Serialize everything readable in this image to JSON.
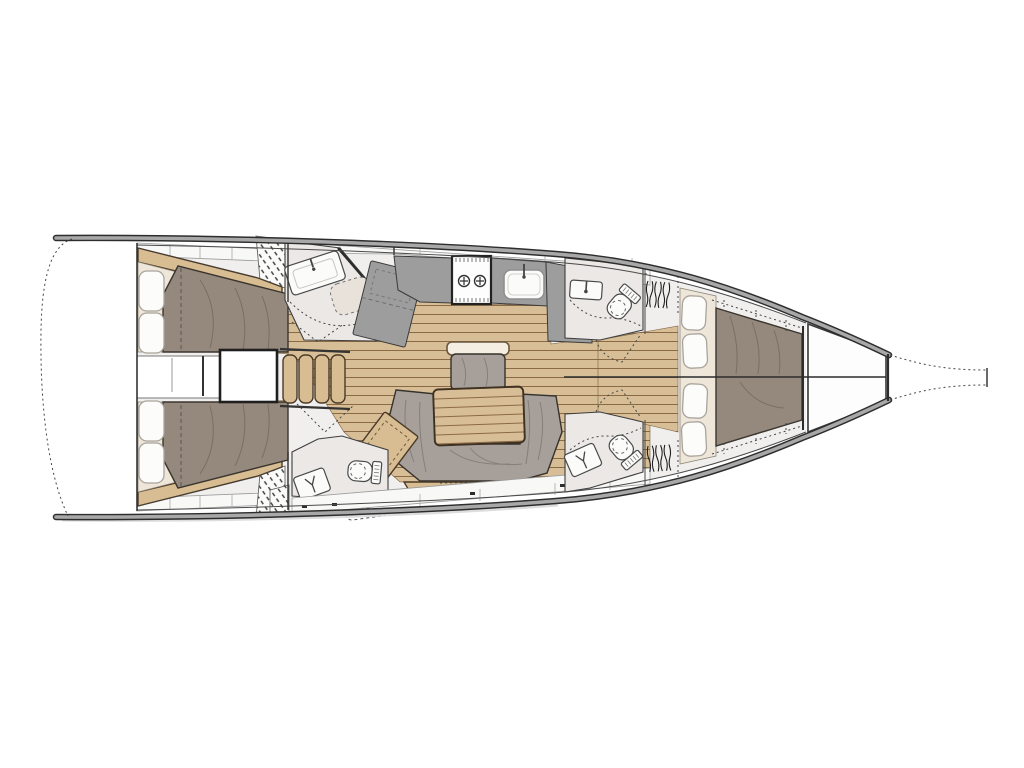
{
  "title": "Sailboat interior layout floor plan",
  "canvas": {
    "width": 1024,
    "height": 768
  },
  "colors": {
    "interior": "#f0efee",
    "room": "#ebe8e5",
    "line": "#3e3e3e",
    "wood_floor": "#d8be97",
    "wood_line": "#8a6a45",
    "furniture_wood": "#d9bd92",
    "furniture_wood_dark": "#4a3a28",
    "duvet": "#95897d",
    "duvet_edge": "#3a352e",
    "mattress": "#efe6da",
    "pillow": "#fcfcfb",
    "pillow_edge": "#a9a49c",
    "upholstery": "#a7a09a",
    "upholstery_edge": "#35312c",
    "counter": "#9d9d9d",
    "fixture": "#fbfbfa",
    "locker": "#f8f8f7",
    "hull_band": "#a8a8a8",
    "hull_edge": "#2d2d2d",
    "shadow": "#d9d9d9"
  },
  "areas": [
    "swim-platform",
    "aft-cabin-port",
    "aft-cabin-starboard",
    "engine-box",
    "companionway-steps",
    "aft-head-port",
    "nav-table",
    "galley",
    "saloon",
    "aft-head-starboard",
    "forward-head-port",
    "forward-head-starboard",
    "forward-cabin",
    "bow-locker",
    "bowsprit"
  ]
}
